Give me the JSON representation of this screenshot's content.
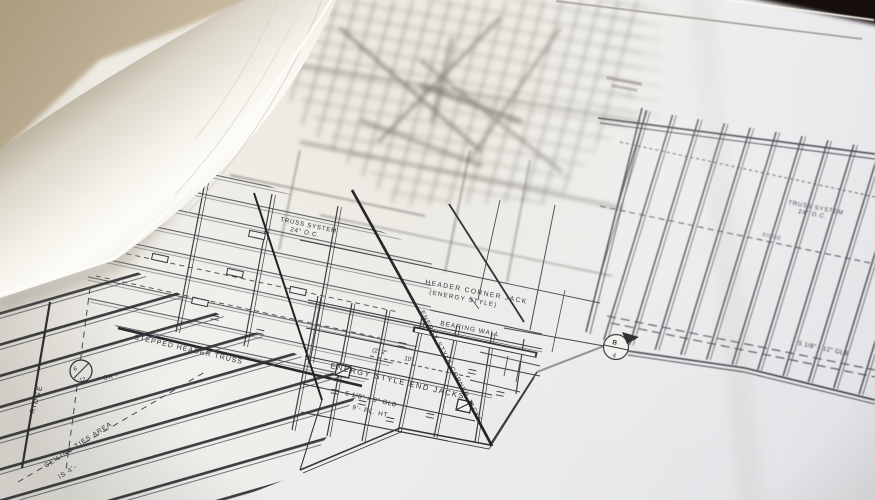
{
  "scene": {
    "description": "Photograph of an open set of construction blueprints (roof framing plan) with pages rolled back on the left",
    "colors": {
      "paper": "#f1f0ec",
      "paper_cool": "#e3e4e7",
      "roll_highlight": "#fdfcf8",
      "roll_shadow": "#c2bcae",
      "background_tan": "#b4a489",
      "background_dark": "#140f0b",
      "ink": "#2c2c31",
      "ink_blurred": "#6e6a60"
    }
  },
  "plan": {
    "labels": {
      "header_corner_jack_1": "HEADER CORNER JACK",
      "header_corner_jack_2": "(ENERGY STYLE)",
      "bearing_wall": "BEARING WALL",
      "dim_2x10_a": "(2) 2\"",
      "dim_2x10_b": "10'-",
      "energy_end_jacks": "ENERGY STYLE END JACKS",
      "energy_corner_jacks": "ENERGY STYLE CORNER JACKS",
      "glb_9": "5 1/8\" x 9\" GLB",
      "plate_height": "9'-  PL. HT.",
      "stepped_header": "STEPPED HEADER TRUSS",
      "truss_system_left_1": "TRUSS SYSTEM",
      "truss_system_left_2": "24\" O.C.",
      "truss_system_right_1": "TRUSS SYSTEM",
      "truss_system_right_2": "24\" O.C.",
      "glb_12": "5 1/8\" - 12\" GLB",
      "ridge_left": "RIDGE",
      "ridge_right": "RIDGE",
      "ceiling_ties_1": "CEILING TIES AREA",
      "ceiling_ties_2": "IS 4'-",
      "pitch_top": "6",
      "pitch_bottom": "12",
      "pitch_tolerance": "+ OR -",
      "section_letter": "B",
      "section_number": "4"
    }
  }
}
